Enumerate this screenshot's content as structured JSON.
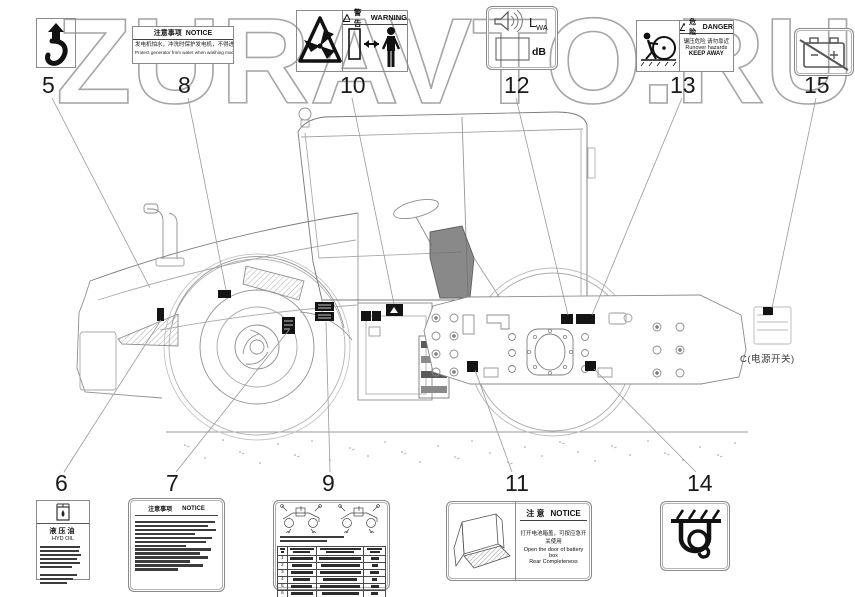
{
  "watermark": {
    "text": "ZURAVTO.RU"
  },
  "callouts": {
    "n5": "5",
    "n6": "6",
    "n7": "7",
    "n8": "8",
    "n9": "9",
    "n10": "10",
    "n11": "11",
    "n12": "12",
    "n13": "13",
    "n14": "14",
    "n15": "15"
  },
  "machine": {
    "power_switch_caption": "C(电源开关)"
  },
  "labels": {
    "l6": {
      "title_cn": "液压油",
      "title_en": "HYD OIL"
    },
    "l7": {
      "header_cn": "注意事项",
      "header_en": "NOTICE"
    },
    "l8": {
      "header_cn": "注意事项",
      "header_en": "NOTICE",
      "line_cn": "发电机怕水，冲洗时保护发电机，不得进水。",
      "line_en": "Protect generator from water when washing machine"
    },
    "l9": {
      "rows": [
        "1",
        "2",
        "3",
        "4",
        "5",
        "6",
        "7",
        "8",
        "9"
      ]
    },
    "l10": {
      "header_cn": "警告",
      "header_en": "WARNING"
    },
    "l11": {
      "header_cn": "注 意",
      "header_en": "NOTICE",
      "line_cn": "打开电池箱盖，可按应急开关使用",
      "line_en1": "Open the door of battery box",
      "line_en2": "Rear Completeness"
    },
    "l12": {
      "lwa": "L",
      "lwa_sub": "WA",
      "unit": "dB"
    },
    "l13": {
      "header_cn": "危险",
      "header_en": "DANGER",
      "line_cn": "辗压危险 请勿靠近",
      "line_en1": "Runover hazards",
      "line_en2": "KEEP AWAY"
    }
  }
}
